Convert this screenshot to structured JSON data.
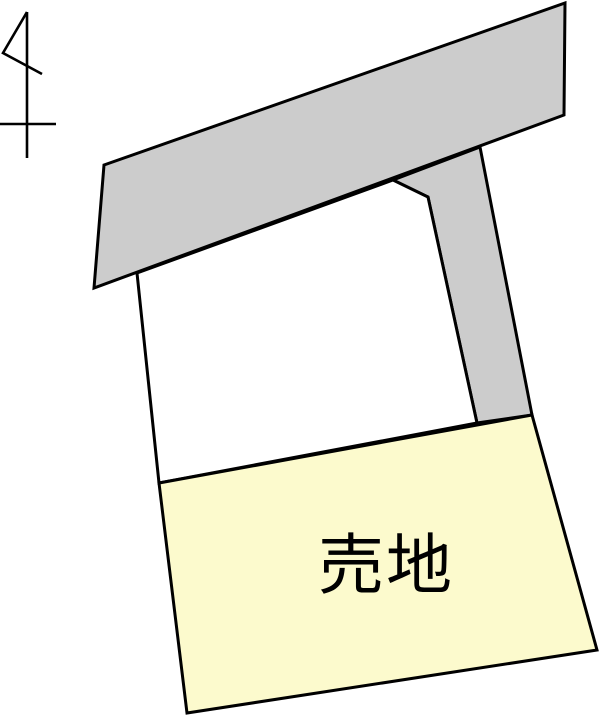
{
  "diagram": {
    "type": "real-estate-plot-plan",
    "canvas": {
      "width": 600,
      "height": 718
    },
    "colors": {
      "background": "#ffffff",
      "road_fill": "#cccccc",
      "neighbor_lot_fill": "#ffffff",
      "sale_lot_fill": "#fcfacd",
      "outline": "#000000",
      "label_color": "#000000",
      "north_arrow_color": "#000000"
    },
    "shapes": {
      "main_road_points": "104,165 565,3 564,115 94,288",
      "side_road_points": "393,180 480,147 532,415 477,423 428,197",
      "neighbor_lot_points": "137,273 393,180 428,197 477,423 159,483",
      "sale_lot_points": "159,483 532,415 597,650 187,713"
    },
    "north_arrow": {
      "shaft_d": "M27,12 L27,158",
      "flag_d": "M27,12 L3,53 L42,74",
      "crossbar_d": "M0,124 L56,124"
    },
    "sale_lot_label": {
      "text": "売地",
      "x": 386,
      "y": 588
    }
  }
}
